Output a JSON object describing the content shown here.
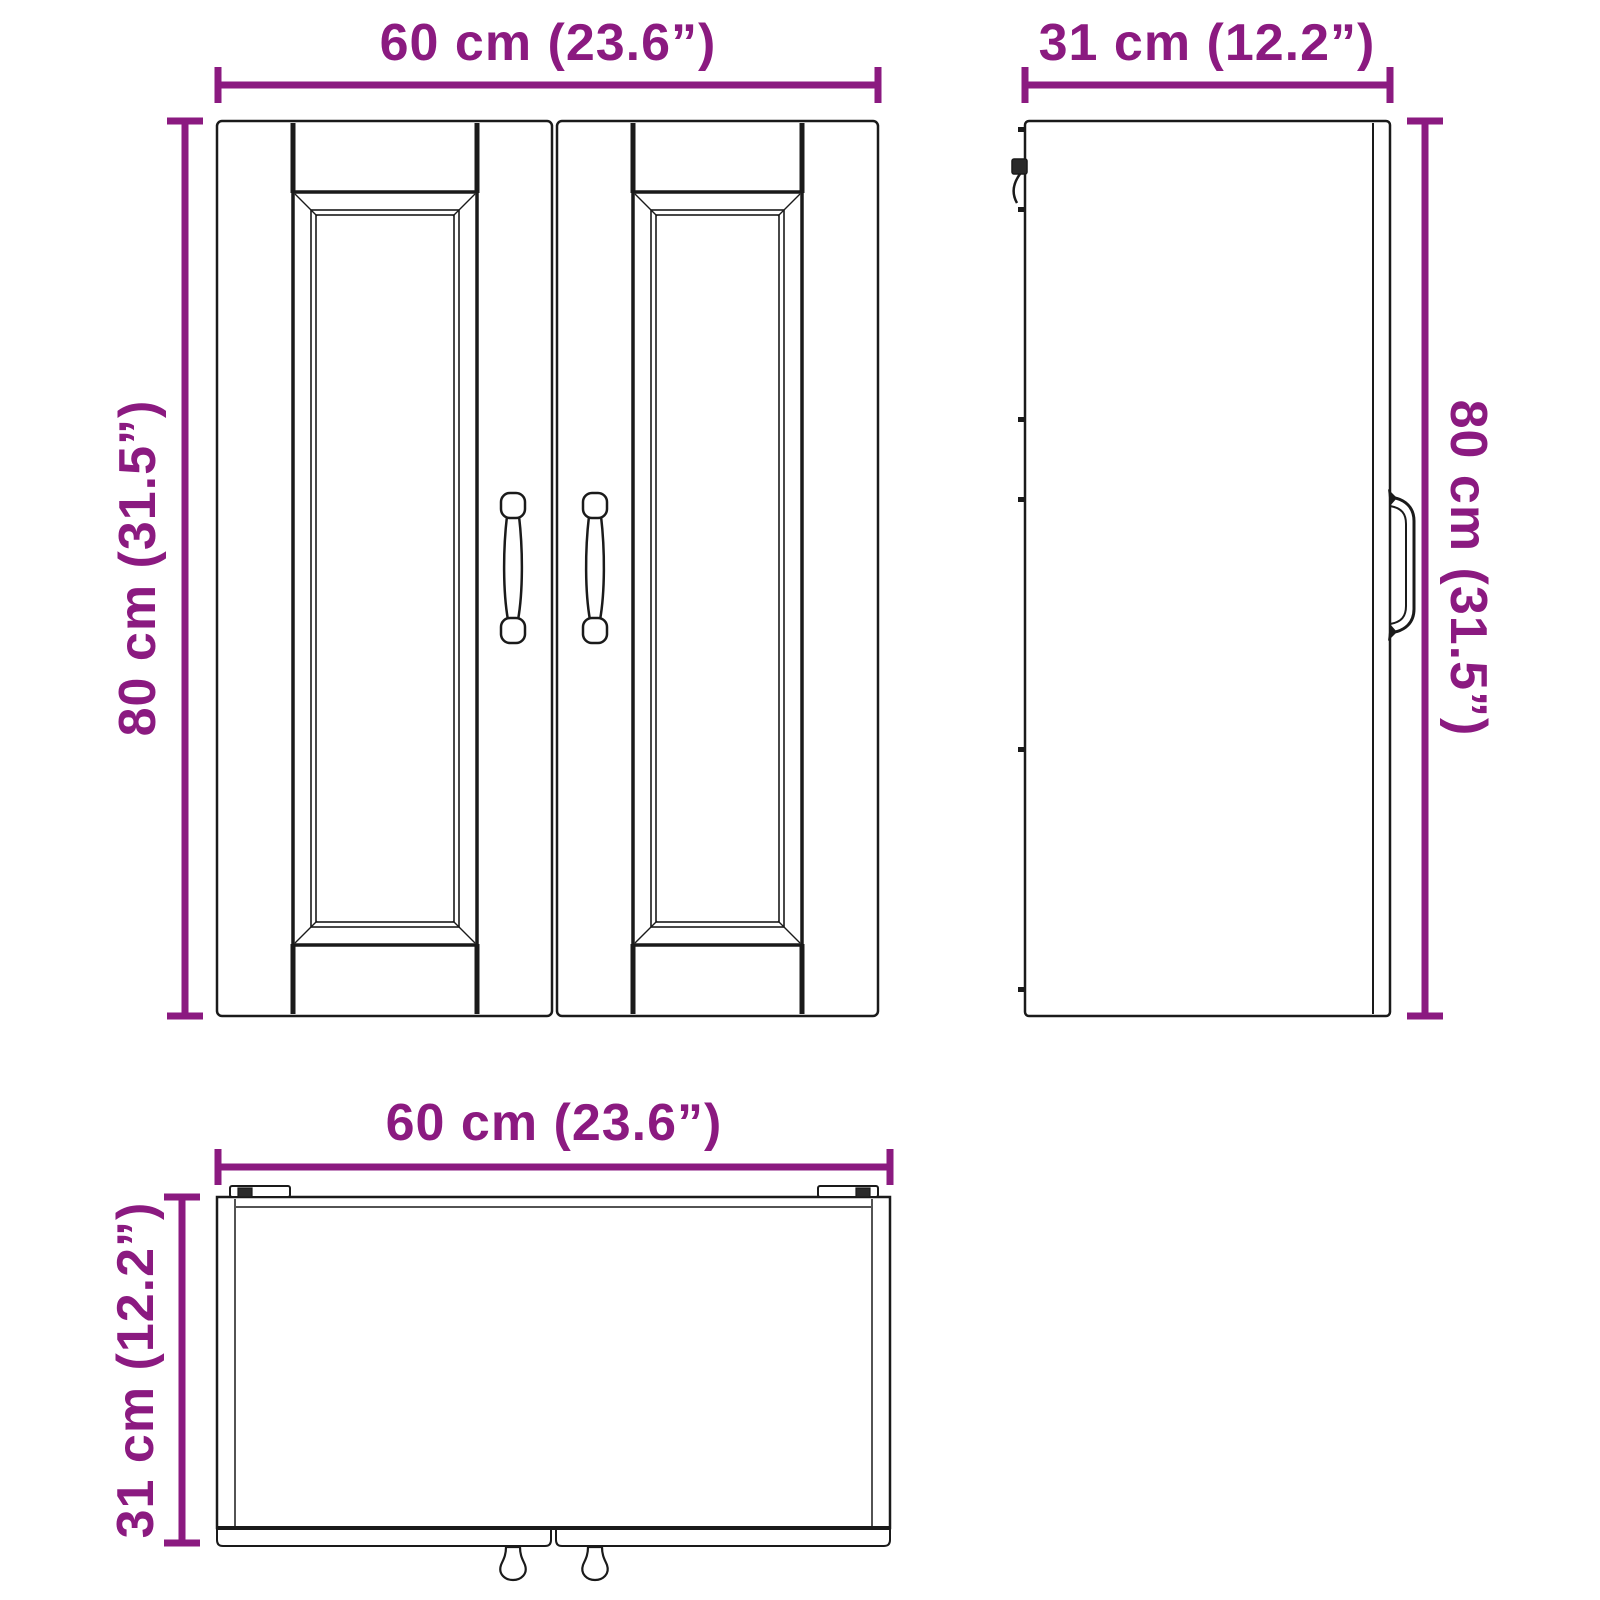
{
  "diagram": {
    "subject": "wall-cabinet-dimension-drawing",
    "colors": {
      "dimension_accent": "#8b1a80",
      "line": "#1a1a1a",
      "background": "#ffffff"
    },
    "views": {
      "front": {
        "width_label": "60 cm (23.6”)",
        "height_label": "80 cm (31.5”)"
      },
      "side": {
        "width_label": "31 cm (12.2”)",
        "height_label": "80 cm (31.5”)"
      },
      "top": {
        "width_label": "60 cm (23.6”)",
        "depth_label": "31 cm (12.2”)"
      }
    }
  }
}
